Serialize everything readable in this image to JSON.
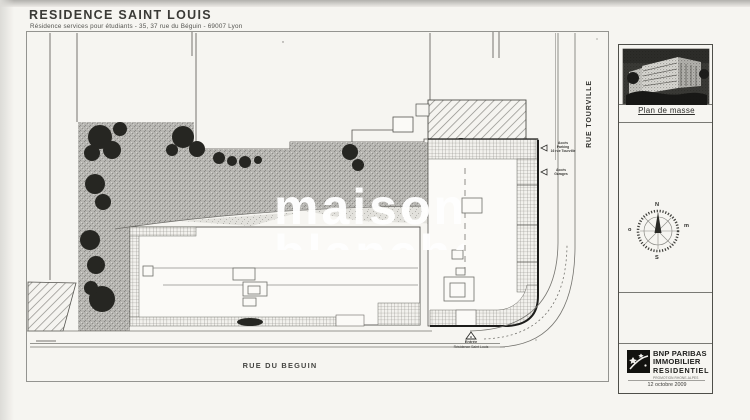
{
  "header": {
    "title": "RESIDENCE SAINT LOUIS",
    "subtitle": "Résidence services pour étudiants - 35, 37 rue du Béguin - 69007 Lyon"
  },
  "plan": {
    "street_right": "RUE TOURVILLE",
    "street_bottom": "RUE DU BEGUIN",
    "annotations": {
      "acces_parking_l1": "Accès",
      "acces_parking_l2": "Parking",
      "acces_parking_l3": "16 rue Tourville",
      "acces_garages_l1": "Accès",
      "acces_garages_l2": "Garages",
      "entree_l1": "Entrée",
      "entree_l2": "Résidence Saint Louis"
    },
    "watermark": {
      "line1": "maison",
      "line2": "blanche"
    }
  },
  "sidebar": {
    "plan_label": "Plan de masse",
    "compass": {
      "north": "N",
      "south": "S",
      "west": "o",
      "east": "m"
    },
    "logo": {
      "line1": "BNP PARIBAS",
      "line2": "IMMOBILIER",
      "line3": "RESIDENTIEL",
      "subline": "PROMOTION RHONE-ALPES",
      "date": "12 octobre 2009"
    }
  },
  "colors": {
    "paper": "#f6f5f1",
    "garden": "#b6b5b1",
    "tree": "#262622",
    "boundary_black": "#1c1c1a",
    "line_gray": "#75746f"
  }
}
